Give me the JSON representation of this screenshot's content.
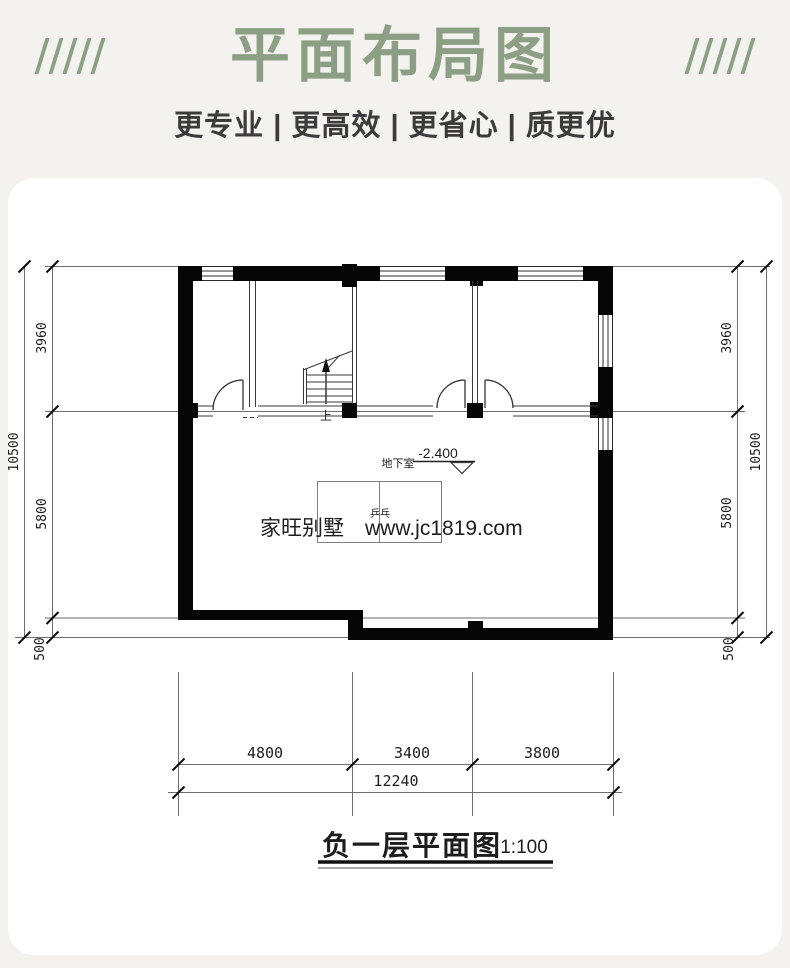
{
  "header": {
    "title": "平面布局图",
    "subtitle": "更专业 | 更高效 | 更省心 | 质更优",
    "accent_color": "#8c9f85"
  },
  "plan": {
    "stair_label": "上",
    "level_label": "地下室",
    "level_value": "-2.400",
    "table_label": "乒乓",
    "watermark": "家旺别墅　www.jc1819.com",
    "dims": {
      "left_top": "3960",
      "left_mid": "5800",
      "left_bottom": "500",
      "left_total": "10500",
      "right_top": "3960",
      "right_mid": "5800",
      "right_bottom": "500",
      "right_total": "10500",
      "bottom_1": "4800",
      "bottom_2": "3400",
      "bottom_3": "3800",
      "bottom_total": "12240"
    }
  },
  "caption": {
    "title": "负一层平面图",
    "scale": "1:100"
  }
}
